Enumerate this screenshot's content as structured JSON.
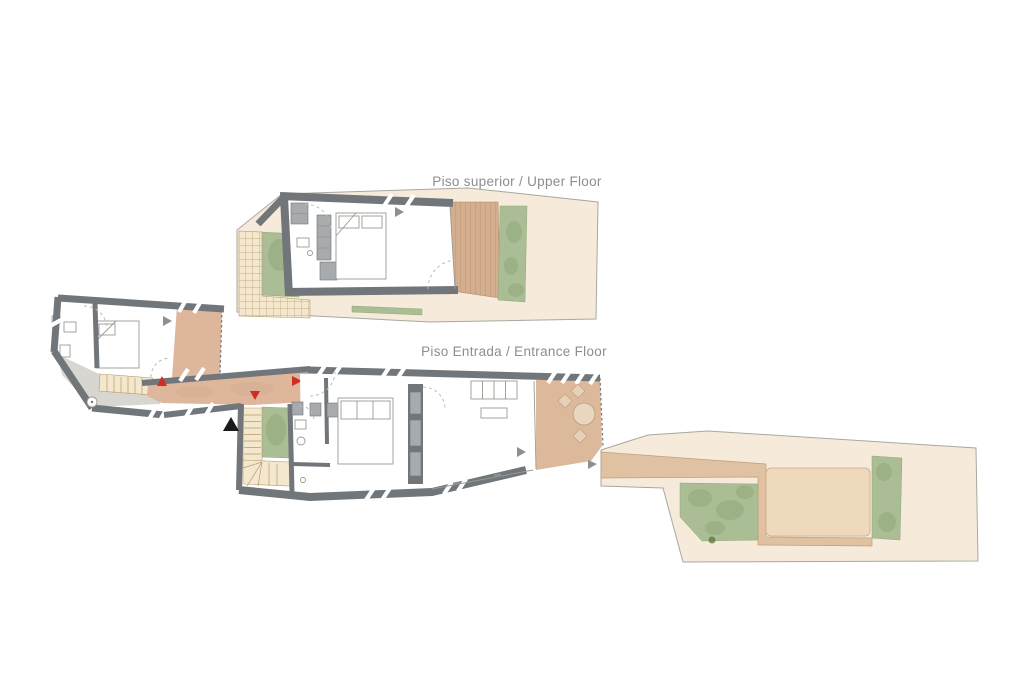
{
  "document": {
    "kind": "architectural floor plan drawing",
    "background": "#ffffff"
  },
  "labels": {
    "upper_floor": "Piso superior / Upper Floor",
    "entrance_floor": "Piso Entrada / Entrance Floor"
  },
  "colors": {
    "label": "#8d8d8d",
    "wall": "#71767a",
    "parcel": "#f6ebdb",
    "deck": "#d4ae8e",
    "terrace": "#dcb99b",
    "corridor": "#ddb69c",
    "path": "#e0c1a2",
    "patio": "#eed9bd",
    "green": "#abbd95",
    "greendark": "#8aa374",
    "stairs": "#f3e7cd",
    "stairline": "#b99a6b",
    "walkway": "#d8d6d0",
    "furngray": "#a7abad",
    "outline": "#a8a89f",
    "thinline": "#9a9a94",
    "red": "#cf2e20",
    "graymark": "#8b9094",
    "black": "#1a1a1a",
    "white": "#ffffff"
  },
  "markers": [
    {
      "name": "gray-view-arrow-upper-bedroom",
      "shape": "triangle-right",
      "color": "#8b9094"
    },
    {
      "name": "gray-view-arrow-left-bedroom",
      "shape": "triangle-right",
      "color": "#8b9094"
    },
    {
      "name": "gray-view-arrow-living-room",
      "shape": "triangle-right",
      "color": "#8b9094"
    },
    {
      "name": "gray-view-arrow-terrace",
      "shape": "triangle-right",
      "color": "#8b9094"
    },
    {
      "name": "red-direction-arrow-up",
      "shape": "triangle-up",
      "color": "#cf2e20"
    },
    {
      "name": "red-direction-arrow-down",
      "shape": "triangle-down",
      "color": "#cf2e20"
    },
    {
      "name": "red-direction-arrow-right",
      "shape": "triangle-right",
      "color": "#cf2e20"
    },
    {
      "name": "black-entrance-arrow",
      "shape": "triangle-up",
      "color": "#1a1a1a"
    }
  ]
}
